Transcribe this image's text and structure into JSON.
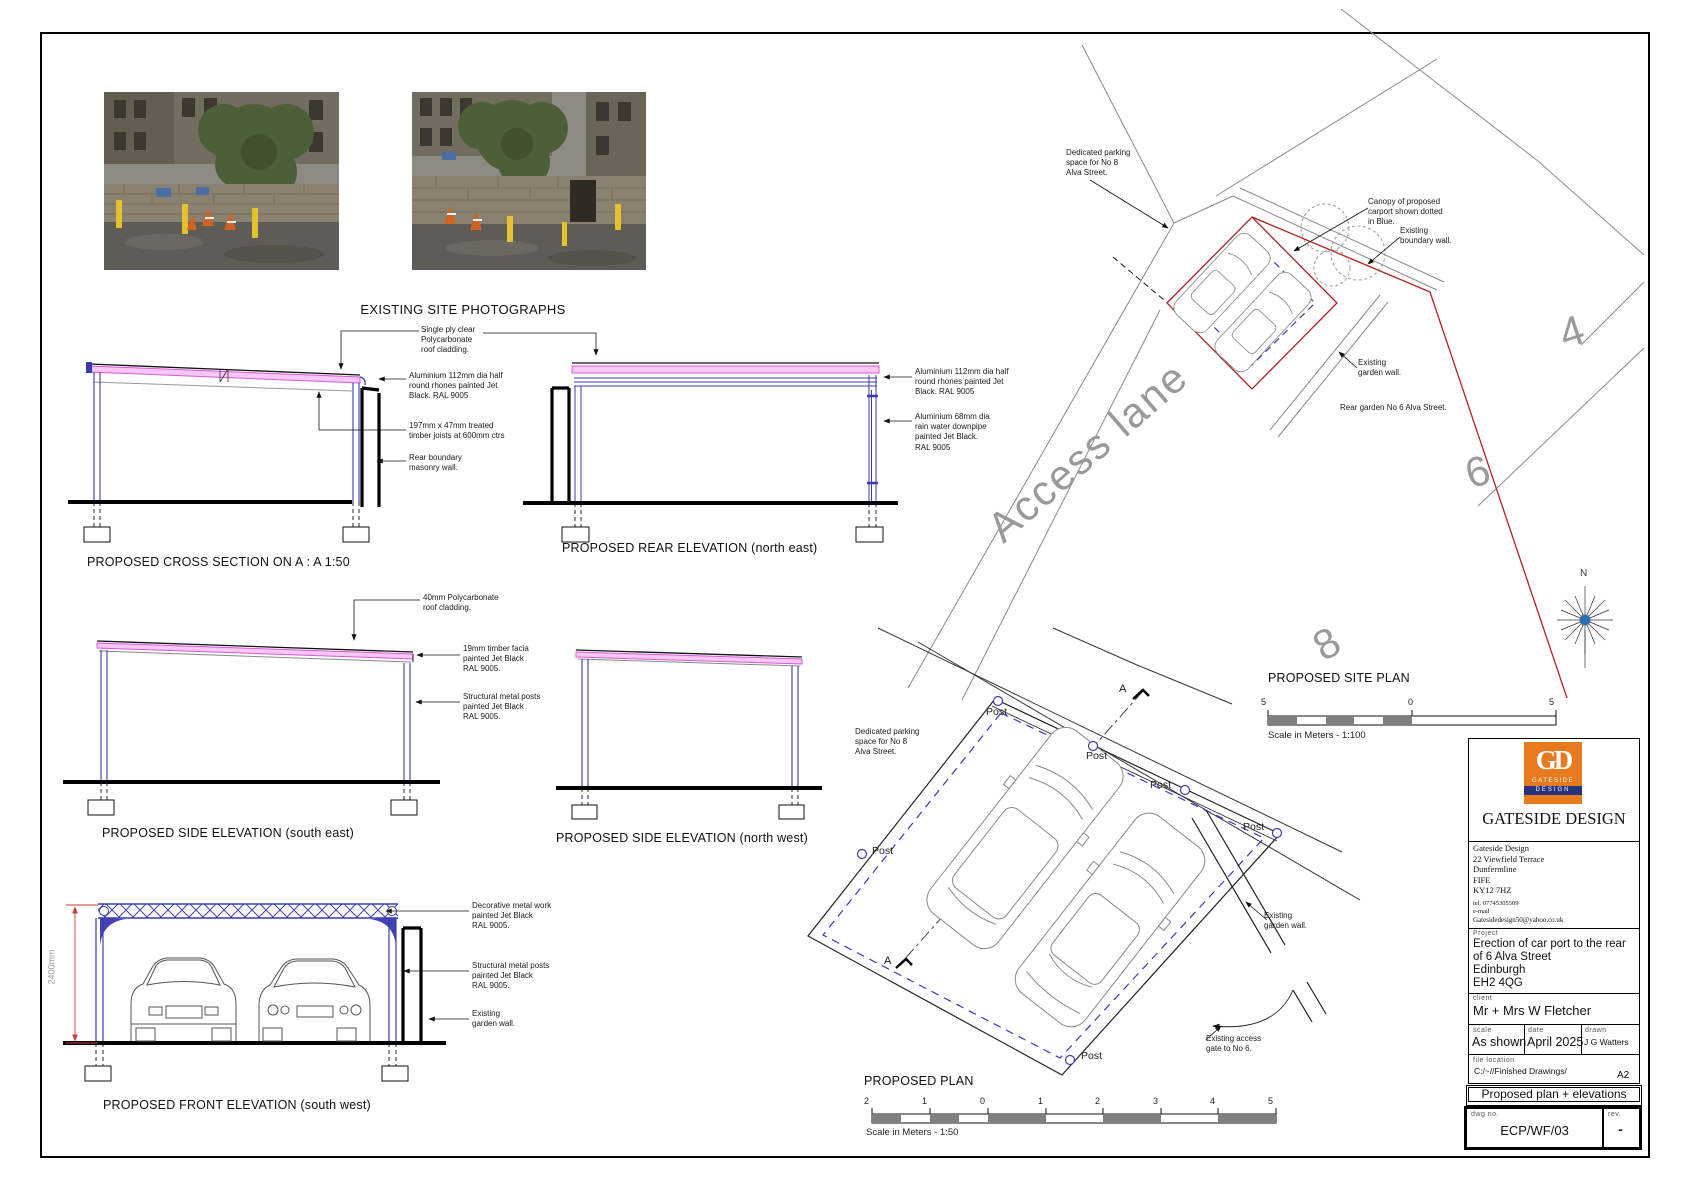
{
  "sheet": {
    "photos_caption": "EXISTING SITE PHOTOGRAPHS"
  },
  "cross_section": {
    "caption": "PROPOSED CROSS SECTION ON A : A   1:50",
    "ann_roof": "Single ply clear\nPolycarbonate\nroof cladding.",
    "ann_rhones": "Aluminium 112mm dia half\nround rhones painted Jet\nBlack. RAL 9005",
    "ann_joists": "197mm x 47mm treated\ntimber joists at 600mm ctrs",
    "ann_wall": "Rear boundary\nmasonry wall."
  },
  "rear_elevation": {
    "caption": "PROPOSED REAR ELEVATION (north east)",
    "ann_rhones": "Aluminium 112mm dia half\nround rhones painted Jet\nBlack. RAL 9005",
    "ann_downpipe": "Aluminium 68mm dia\nrain water downpipe\npainted Jet Black.\nRAL 9005"
  },
  "side_elevation_se": {
    "caption": "PROPOSED SIDE ELEVATION (south east)",
    "ann_roof": "40mm Polycarbonate\nroof cladding.",
    "ann_facia": "19mm timber facia\npainted Jet Black\nRAL 9005.",
    "ann_posts": "Structural metal posts\npainted Jet Black\nRAL 9005."
  },
  "side_elevation_nw": {
    "caption": "PROPOSED SIDE ELEVATION (north west)"
  },
  "front_elevation": {
    "caption": "PROPOSED FRONT ELEVATION (south west)",
    "dim_height": "2400mm",
    "ann_decorative": "Decorative metal work\npainted Jet Black\nRAL 9005.",
    "ann_posts": "Structural metal posts\npainted Jet Black\nRAL 9005.",
    "ann_wall": "Existing\ngarden wall."
  },
  "site_plan": {
    "caption": "PROPOSED SITE PLAN",
    "access_lane_label": "Access lane",
    "plot_number_4": "4",
    "plot_number_6": "6",
    "plot_number_8": "8",
    "ann_parking": "Dedicated parking\nspace for No 8\nAlva Street.",
    "ann_canopy": "Canopy of proposed\ncarport shown dotted\nin Blue.",
    "ann_boundary_wall": "Existing\nboundary wall.",
    "ann_garden_wall": "Existing\ngarden wall.",
    "ann_rear_garden": "Rear garden No 6 Alva Street.",
    "compass_north": "N",
    "scale_caption": "Scale in Meters - 1:100",
    "scale_ticks": [
      "5",
      "0",
      "5"
    ]
  },
  "plan": {
    "caption": "PROPOSED PLAN",
    "ann_parking": "Dedicated parking\nspace for No 8\nAlva Street.",
    "ann_garden_wall": "Existing\ngarden wall.",
    "ann_gate": "Existing access\ngate to No 6.",
    "post_label": "Post",
    "section_marker": "A",
    "scale_caption": "Scale in Meters - 1:50",
    "scale_ticks": [
      "2",
      "1",
      "0",
      "1",
      "2",
      "3",
      "4",
      "5"
    ]
  },
  "title_block": {
    "logo_monogram": "GD",
    "logo_name_line1": "GATESIDE",
    "logo_name_line2": "DESIGN",
    "company_name": "GATESIDE DESIGN",
    "address": "Gateside Design\n22 Viewfield Terrace\nDunfermline\nFIFE\nKY12 7HZ",
    "tel": "tel. 07745305509",
    "email_label": "e-mail",
    "email": "Gatesidedesign50@yahoo.co.uk",
    "project_label": "Project",
    "project": "Erection of car port to the rear of 6 Alva Street\nEdinburgh\nEH2 4QG",
    "client_label": "client",
    "client": "Mr + Mrs W Fletcher",
    "scale_label": "scale",
    "scale_value": "As shown",
    "date_label": "date",
    "date_value": "April 2025",
    "drawn_label": "drawn",
    "drawn_value": "J G Watters",
    "file_label": "file  location",
    "file_value": "C:/~//Finished Drawings/",
    "sheet_size": "A2",
    "drawing_title": "Proposed plan + elevations",
    "dwg_label": "dwg  no.",
    "dwg_value": "ECP/WF/03",
    "rev_label": "rev.",
    "rev_value": "-"
  },
  "colors": {
    "structure_blue": "#3b3bb0",
    "roof_magenta": "#d957d9",
    "boundary_red": "#b22222",
    "logo_orange": "#e87a1e"
  }
}
